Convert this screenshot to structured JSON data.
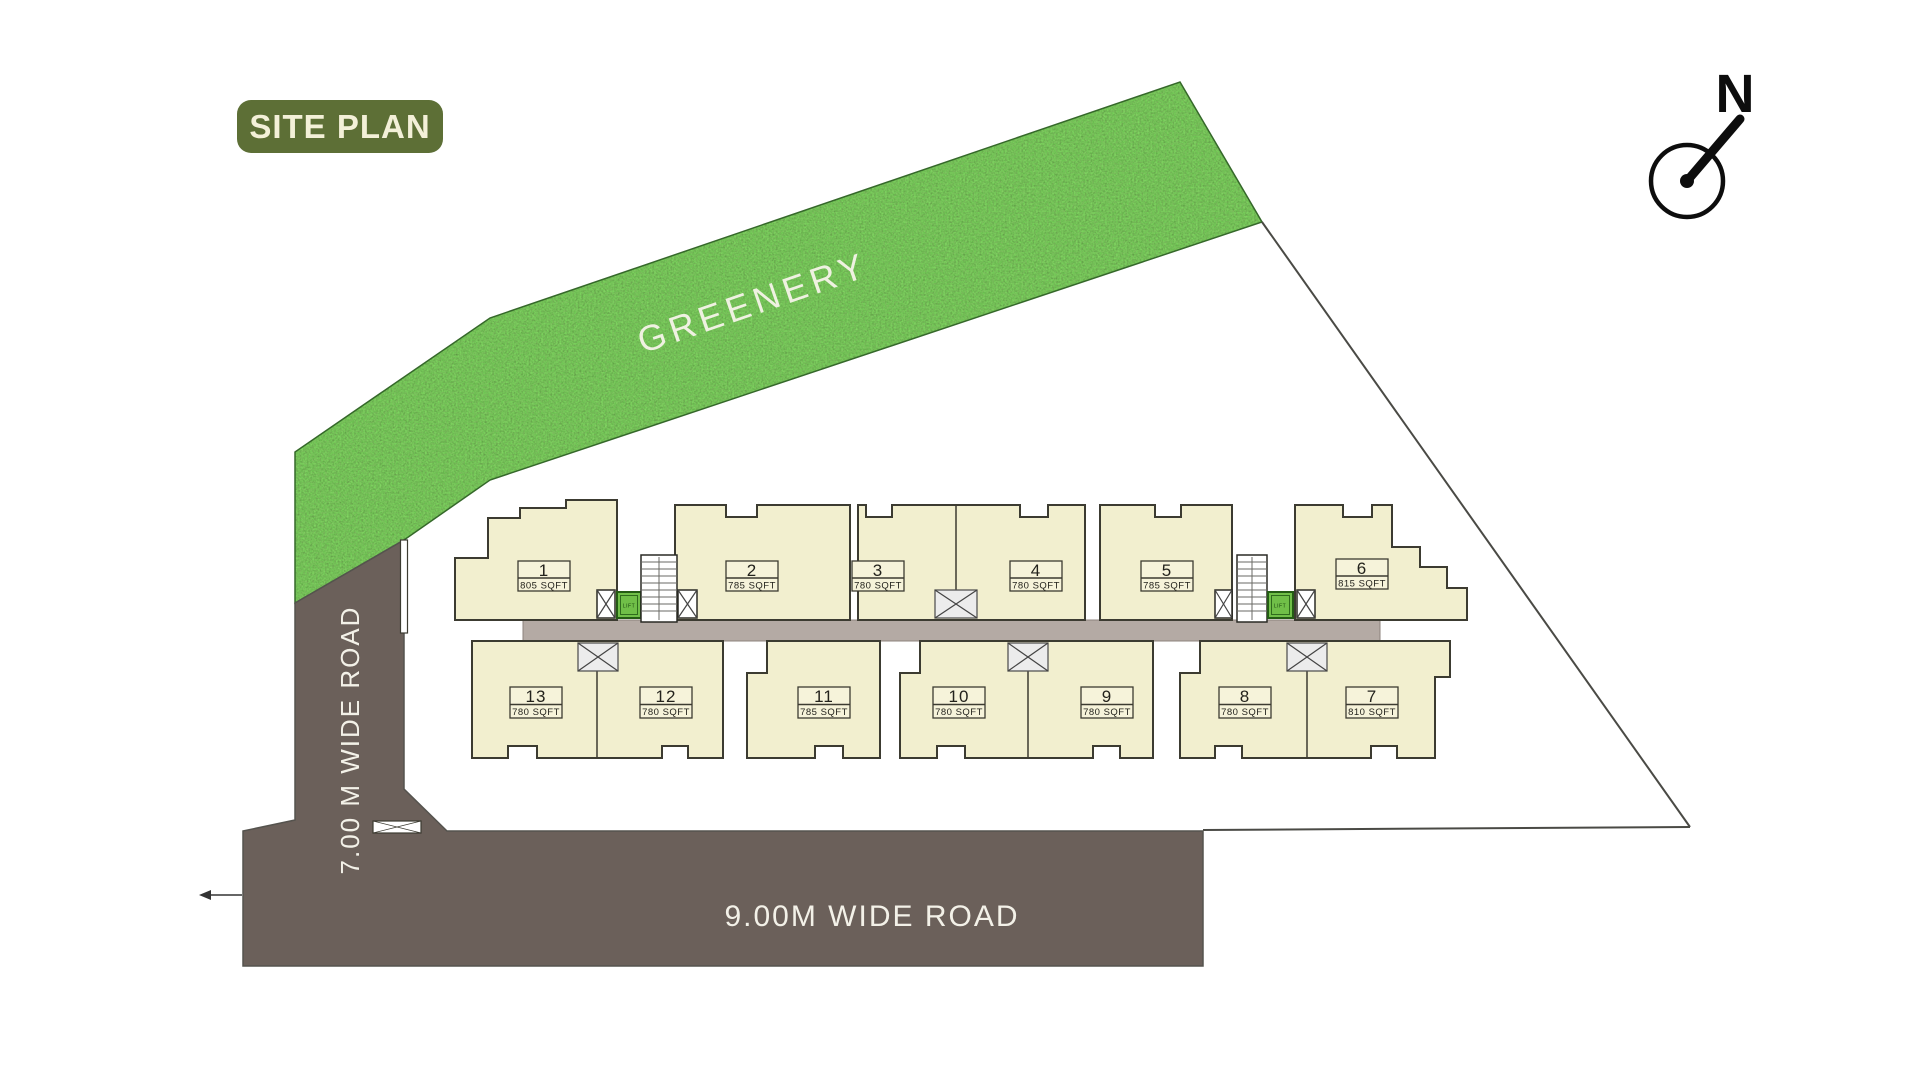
{
  "header": {
    "title": "SITE PLAN"
  },
  "compass": {
    "north_label": "N"
  },
  "greenery": {
    "label": "GREENERY"
  },
  "roads": {
    "left_road": "7.00 M WIDE ROAD",
    "bottom_road": "9.00M WIDE ROAD"
  },
  "core": {
    "lift_label": "LIFT"
  },
  "units": [
    {
      "number": "1",
      "area": "805 SQFT"
    },
    {
      "number": "2",
      "area": "785 SQFT"
    },
    {
      "number": "3",
      "area": "780 SQFT"
    },
    {
      "number": "4",
      "area": "780 SQFT"
    },
    {
      "number": "5",
      "area": "785 SQFT"
    },
    {
      "number": "6",
      "area": "815 SQFT"
    },
    {
      "number": "7",
      "area": "810 SQFT"
    },
    {
      "number": "8",
      "area": "780 SQFT"
    },
    {
      "number": "9",
      "area": "780 SQFT"
    },
    {
      "number": "10",
      "area": "780 SQFT"
    },
    {
      "number": "11",
      "area": "785 SQFT"
    },
    {
      "number": "12",
      "area": "780 SQFT"
    },
    {
      "number": "13",
      "area": "780 SQFT"
    }
  ],
  "colors": {
    "banner": "#5d6f36",
    "greenery": "#4b8b39",
    "road": "#6b605a",
    "corridor": "#b4aaa4",
    "unit_fill": "#f2efcf",
    "lift_green": "#70bf48"
  }
}
